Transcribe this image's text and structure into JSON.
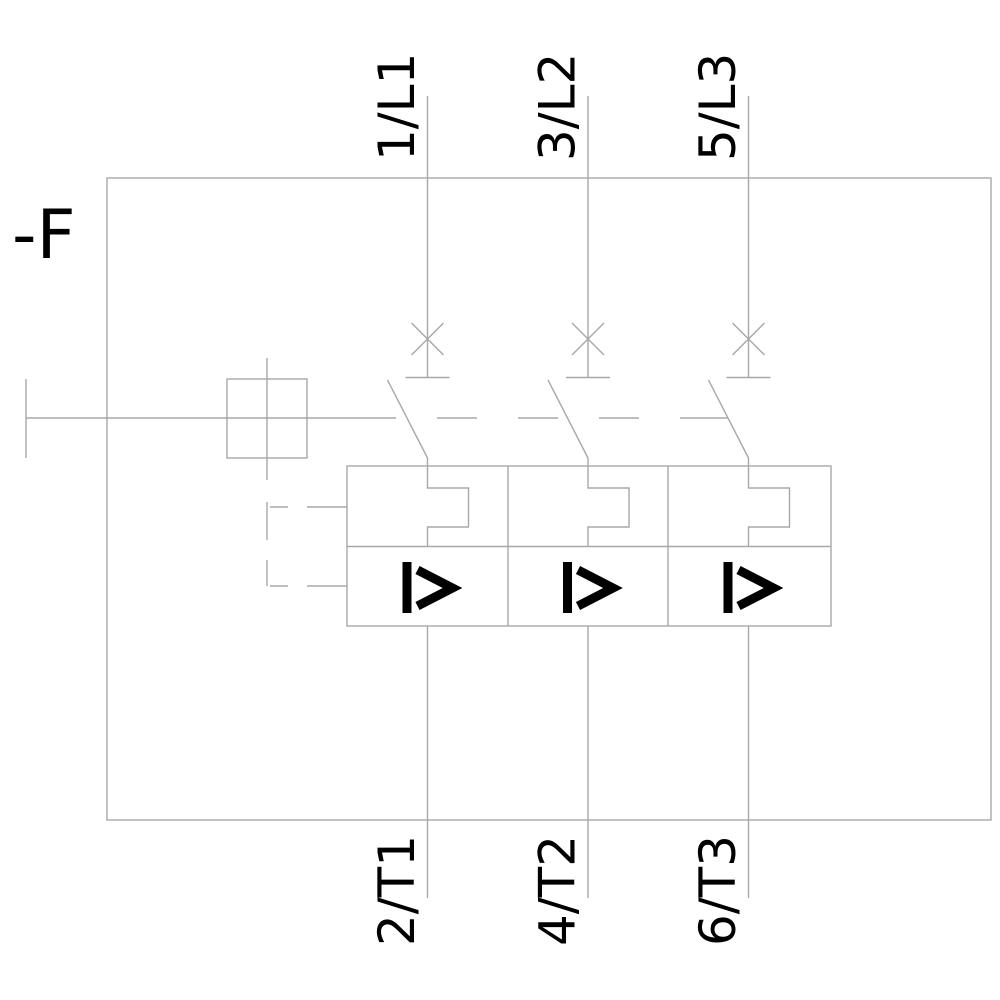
{
  "device_label": "-F",
  "terminals": {
    "top": [
      "1/L1",
      "3/L2",
      "5/L3"
    ],
    "bottom": [
      "2/T1",
      "4/T2",
      "6/T3"
    ]
  },
  "symbols": {
    "overcurrent_release": "I>"
  },
  "colors": {
    "line": "#a8a8a8",
    "text": "#000000",
    "background": "#ffffff"
  }
}
